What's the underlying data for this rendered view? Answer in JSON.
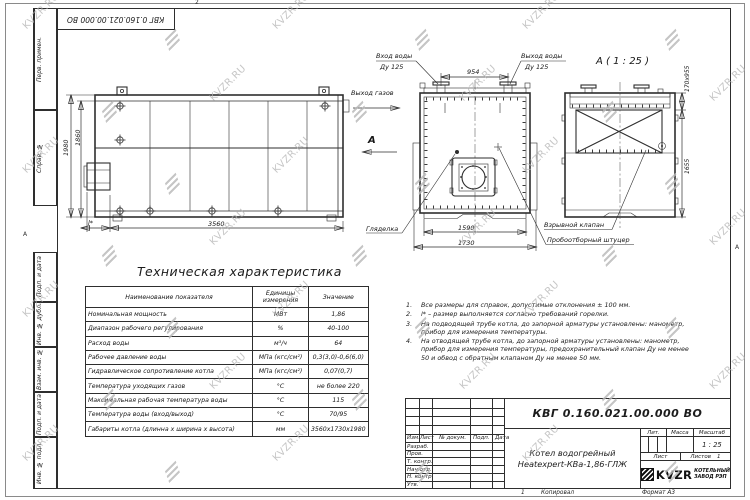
{
  "doc": {
    "number": "КВГ 0.160.021.00.000 ВО",
    "name_line1": "Котел водогрейный",
    "name_line2": "Heatexpert-КВа-1,86-ГЛЖ",
    "scale_value": "1 : 25",
    "sheets_value": "1",
    "zone_top": "2",
    "zone_left": "А",
    "zone_right": "А",
    "bottom_zone": "1",
    "copied": "Копировал",
    "format": "Формат А3"
  },
  "watermark": {
    "text": "KVZR.RU"
  },
  "margin_labels": [
    "Перв. примен.",
    "Справ. №",
    "Подп. и дата",
    "Инв. № дубл.",
    "Взам. инв. №",
    "Подп. и дата",
    "Инв. № подл."
  ],
  "stamp": {
    "col_izm": "Изм.",
    "col_list": "Лист",
    "col_doc": "№ докум.",
    "col_sign": "Подп.",
    "col_date": "Дата",
    "rows": [
      "Разраб.",
      "Пров.",
      "Т. контр.",
      "Нач.отд.",
      "Н. контр.",
      "Утв."
    ],
    "lit": "Лит.",
    "mass": "Масса",
    "scale": "Масштаб",
    "sheet": "Лист",
    "sheets": "Листов",
    "logo": "KVZR",
    "logo_line1": "КОТЕЛЬНЫЙ",
    "logo_line2": "ЗАВОД РЭП"
  },
  "views": {
    "side": {
      "dim_height": "1980",
      "dim_height_inner": "1860",
      "dim_length": "3560",
      "dim_burner": "l*"
    },
    "front": {
      "gas_out": "Выход газов",
      "view_mark": "А",
      "water_in1": "Вход воды",
      "water_in2": "Ду 125",
      "water_out1": "Выход воды",
      "water_out2": "Ду 125",
      "dim_nozzles": "954",
      "dim_width_inner": "1590",
      "dim_width": "1730",
      "sight": "Гляделка"
    },
    "rear": {
      "title": "А ( 1 : 25 )",
      "dim_flue": "170х955",
      "dim_height": "1655",
      "valve": "Взрывной клапан",
      "fitting": "Пробоотборный штуцер"
    }
  },
  "table": {
    "title": "Техническая характеристика",
    "h_name": "Наименование показателя",
    "h_unit": "Единицы измерения",
    "h_value": "Значение",
    "rows": [
      [
        "Номинальная мощность",
        "МВт",
        "1,86"
      ],
      [
        "Диапазон рабочего регулирования",
        "%",
        "40-100"
      ],
      [
        "Расход воды",
        "м³/ч",
        "64"
      ],
      [
        "Рабочее давление воды",
        "МПа (кгс/см²)",
        "0,3(3,0)-0,6(6,0)"
      ],
      [
        "Гидравлическое сопротивление котла",
        "МПа (кгс/см²)",
        "0,07(0,7)"
      ],
      [
        "Температура уходящих газов",
        "°С",
        "не более 220"
      ],
      [
        "Максимальная рабочая температура воды",
        "°С",
        "115"
      ],
      [
        "Температура воды (вход/выход)",
        "°С",
        "70/95"
      ],
      [
        "Габариты котла (длинна х ширина х высота)",
        "мм",
        "3560х1730х1980"
      ]
    ]
  },
  "notes": [
    {
      "num": "1.",
      "text": "Все размеры для справок, допустимые отклонения ± 100 мм."
    },
    {
      "num": "2.",
      "text": "l* – размер выполняется согласно требований горелки."
    },
    {
      "num": "3.",
      "text": "На подводящей трубе котла, до запорной арматуры установлены: манометр, прибор для измерения температуры."
    },
    {
      "num": "4.",
      "text": "На отводящей трубе котла, до запорной арматуры установлены: манометр, прибор для измерения температуры, предохранительный клапан Ду не менее 50 и обвод с обратным клапаном Ду не менее 50 мм."
    }
  ]
}
